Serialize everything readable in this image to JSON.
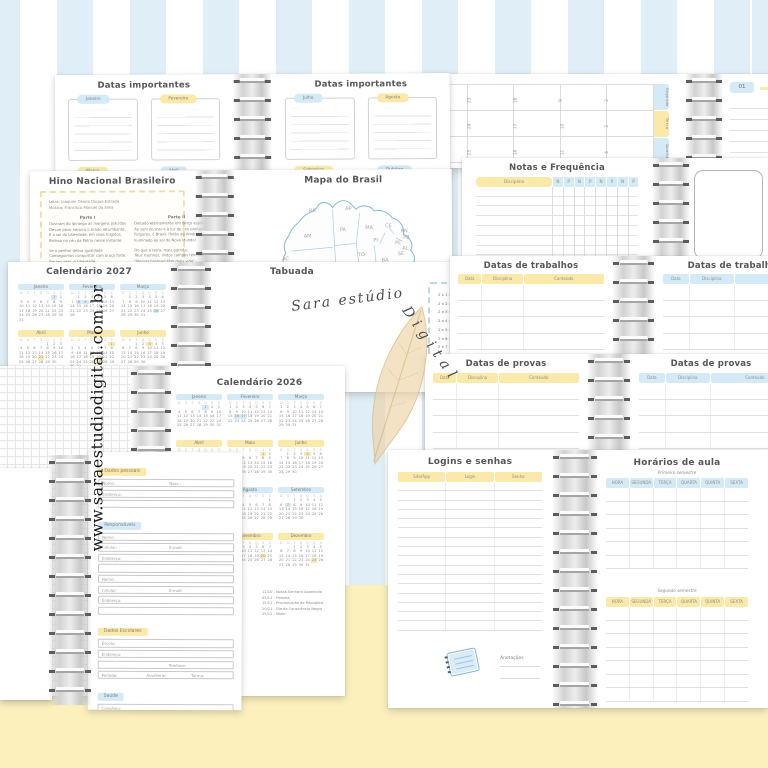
{
  "background": {
    "stripe_blue": "#e0eef7",
    "bottom_yellow": "#fcf1bd"
  },
  "palette": {
    "blue": "#d4eaf6",
    "yellow": "#fbe9a9"
  },
  "watermark": {
    "site": "www.saraestudiodigital.com.br",
    "brand_part1": "Sara estúdio",
    "brand_part2": "Digital"
  },
  "weekday_letters": [
    "D",
    "S",
    "T",
    "Q",
    "Q",
    "S",
    "S"
  ],
  "datas_importantes": {
    "title": "Datas importantes",
    "left_months": [
      {
        "name": "Janeiro",
        "hue": "blue"
      },
      {
        "name": "Fevereiro",
        "hue": "yellow"
      },
      {
        "name": "Março",
        "hue": "yellow"
      },
      {
        "name": "Abril",
        "hue": "blue"
      }
    ],
    "right_months": [
      {
        "name": "Julho",
        "hue": "blue"
      },
      {
        "name": "Agosto",
        "hue": "yellow"
      },
      {
        "name": "Setembro",
        "hue": "yellow"
      },
      {
        "name": "Outubro",
        "hue": "blue"
      }
    ]
  },
  "monthly_view": {
    "date_label": "01",
    "day_tabs": [
      {
        "name": "Segunda",
        "hue": "blue"
      },
      {
        "name": "Terça",
        "hue": "yellow"
      },
      {
        "name": "Quarta",
        "hue": "blue"
      }
    ],
    "grid_numbers": [
      [
        "30",
        "23",
        "16",
        "9",
        "2"
      ],
      [
        "31",
        "24",
        "17",
        "10",
        "3"
      ],
      [
        "1",
        "25",
        "18",
        "11",
        "4"
      ]
    ]
  },
  "notas": {
    "title": "Notas e Frequência",
    "disciplina": "Disciplina",
    "cols": [
      "N",
      "P",
      "N",
      "P",
      "N",
      "P",
      "N",
      "P"
    ],
    "rows": 8
  },
  "hino": {
    "title": "Hino Nacional Brasileiro",
    "credits": [
      "Letra: Joaquim Osório Duque Estrada",
      "Música: Francisco Manuel da Silva"
    ],
    "part1_title": "Parte I",
    "part2_title": "Parte II",
    "part1": [
      "Ouviram do Ipiranga as margens plácidas",
      "De um povo heroico o brado retumbante,",
      "E o sol da Liberdade, em raios fúlgidos,",
      "Brilhou no céu da Pátria nesse instante.",
      "",
      "Se o penhor dessa igualdade",
      "Conseguimos conquistar com braço forte,",
      "Em teu seio, ó Liberdade,",
      "Desafia o nosso peito a própria morte!"
    ],
    "part2": [
      "Deitado eternamente em berço esplêndido,",
      "Ao som do mar e à luz do céu profundo,",
      "Fulguras, ó Brasil, florão da América,",
      "Iluminado ao sol do Novo Mundo!",
      "",
      "Do que a terra, mais garrida,",
      "Teus risonhos, lindos campos têm mais flores;",
      "\"Nossos bosques têm mais vida\",",
      "\"Nossa vida\" no teu seio \"mais amores.\""
    ]
  },
  "mapa": {
    "title": "Mapa do Brasil",
    "states": [
      {
        "t": "RR",
        "x": 62,
        "y": 27
      },
      {
        "t": "AP",
        "x": 102,
        "y": 25
      },
      {
        "t": "AM",
        "x": 56,
        "y": 55
      },
      {
        "t": "PA",
        "x": 96,
        "y": 48
      },
      {
        "t": "MA",
        "x": 124,
        "y": 46
      },
      {
        "t": "CE",
        "x": 146,
        "y": 44
      },
      {
        "t": "RN",
        "x": 163,
        "y": 50
      },
      {
        "t": "PB",
        "x": 166,
        "y": 57
      },
      {
        "t": "PE",
        "x": 157,
        "y": 63
      },
      {
        "t": "AL",
        "x": 165,
        "y": 69
      },
      {
        "t": "SE",
        "x": 160,
        "y": 75
      },
      {
        "t": "PI",
        "x": 133,
        "y": 60
      },
      {
        "t": "BA",
        "x": 142,
        "y": 82
      },
      {
        "t": "TO",
        "x": 116,
        "y": 76
      },
      {
        "t": "RO",
        "x": 58,
        "y": 86
      },
      {
        "t": "AC",
        "x": 32,
        "y": 80
      },
      {
        "t": "MT",
        "x": 84,
        "y": 90
      },
      {
        "t": "DF",
        "x": 120,
        "y": 94
      },
      {
        "t": "GO",
        "x": 112,
        "y": 102
      },
      {
        "t": "MG",
        "x": 134,
        "y": 108
      },
      {
        "t": "MS",
        "x": 92,
        "y": 118
      },
      {
        "t": "ES",
        "x": 153,
        "y": 112
      },
      {
        "t": "RJ",
        "x": 143,
        "y": 121
      },
      {
        "t": "SP",
        "x": 116,
        "y": 126
      },
      {
        "t": "PR",
        "x": 106,
        "y": 138
      },
      {
        "t": "SC",
        "x": 101,
        "y": 148
      },
      {
        "t": "RS",
        "x": 93,
        "y": 160
      }
    ]
  },
  "calendario_2027": {
    "title": "Calendário 2027",
    "months": [
      {
        "name": "Janeiro",
        "days": 31,
        "start": 5,
        "hue": "blue",
        "marks": [
          1
        ]
      },
      {
        "name": "Fevereiro",
        "days": 28,
        "start": 1,
        "hue": "blue",
        "marks": [
          8,
          9
        ]
      },
      {
        "name": "Março",
        "days": 31,
        "start": 1,
        "hue": "blue",
        "marks": [
          26
        ]
      },
      {
        "name": "Abril",
        "days": 30,
        "start": 4,
        "hue": "yellow",
        "marks": [
          21
        ]
      },
      {
        "name": "Maio",
        "days": 31,
        "start": 6,
        "hue": "yellow",
        "marks": [
          1,
          27
        ]
      },
      {
        "name": "Junho",
        "days": 30,
        "start": 2,
        "hue": "yellow",
        "marks": [
          3
        ]
      }
    ]
  },
  "tabuada": {
    "title": "Tabuada",
    "tables": [
      2,
      3,
      4
    ],
    "rows_per_table": 10
  },
  "trabalhos": {
    "title": "Datas de trabalhos",
    "cols": [
      "Data",
      "Disciplina",
      "Conteúdo"
    ],
    "rows": 4
  },
  "provas": {
    "title": "Datas de provas",
    "cols": [
      "Data",
      "Disciplina",
      "Conteúdo"
    ],
    "rows": 4
  },
  "calendario_2026": {
    "title": "Calendário 2026",
    "months": [
      {
        "name": "Janeiro",
        "days": 31,
        "start": 4,
        "hue": "blue",
        "marks": [
          1
        ]
      },
      {
        "name": "Fevereiro",
        "days": 28,
        "start": 0,
        "hue": "blue",
        "marks": [
          16,
          17
        ]
      },
      {
        "name": "Março",
        "days": 31,
        "start": 0,
        "hue": "blue",
        "marks": []
      },
      {
        "name": "Abril",
        "days": 30,
        "start": 3,
        "hue": "yellow",
        "marks": [
          3,
          21
        ]
      },
      {
        "name": "Maio",
        "days": 31,
        "start": 5,
        "hue": "yellow",
        "marks": [
          1
        ]
      },
      {
        "name": "Junho",
        "days": 30,
        "start": 1,
        "hue": "yellow",
        "marks": [
          4
        ]
      },
      {
        "name": "Julho",
        "days": 31,
        "start": 3,
        "hue": "blue",
        "marks": []
      },
      {
        "name": "Agosto",
        "days": 31,
        "start": 6,
        "hue": "blue",
        "marks": []
      },
      {
        "name": "Setembro",
        "days": 30,
        "start": 2,
        "hue": "blue",
        "marks": [
          7
        ]
      },
      {
        "name": "Outubro",
        "days": 31,
        "start": 4,
        "hue": "yellow",
        "marks": [
          12
        ]
      },
      {
        "name": "Novembro",
        "days": 30,
        "start": 0,
        "hue": "yellow",
        "marks": [
          2,
          15,
          20
        ]
      },
      {
        "name": "Dezembro",
        "days": 31,
        "start": 2,
        "hue": "yellow",
        "marks": [
          25
        ]
      }
    ],
    "holidays_left": [
      "21/04 - Tiradentes",
      "01/05 - Dia do Trabalhador",
      "04/06 - Corpus Christi",
      "07/09 - Independência do Brasil"
    ],
    "holidays_right": [
      "12/10 - Nossa Senhora Aparecida",
      "02/11 - Finados",
      "15/11 - Proclamação da República",
      "20/11 - Dia da Consciência Negra",
      "25/12 - Natal"
    ]
  },
  "dados_pessoais": {
    "sections": [
      {
        "label": "Dados pessoais",
        "hue": "yellow",
        "rows": [
          [
            "Nome:",
            "Nasc.:"
          ],
          [
            "Endereço:"
          ],
          [
            ""
          ]
        ]
      },
      {
        "label": "Responsáveis",
        "hue": "blue",
        "rows": [
          [
            "Nome:"
          ],
          [
            "Celular:",
            "E-mail:"
          ],
          [
            "Endereço:"
          ],
          [
            ""
          ],
          [
            "Nome:"
          ],
          [
            "Celular:",
            "E-mail:"
          ],
          [
            "Endereço:"
          ],
          [
            ""
          ]
        ]
      },
      {
        "label": "Dados Escolares",
        "hue": "yellow",
        "rows": [
          [
            "Escola:"
          ],
          [
            "Endereço:"
          ],
          [
            "",
            "Telefone:"
          ],
          [
            "Período:",
            "Ano/Série:",
            "Turma:"
          ]
        ]
      },
      {
        "label": "Saúde",
        "hue": "blue",
        "rows": [
          [
            "Convênio:"
          ],
          [
            "Tipo sanguíneo:",
            "Fator RH:"
          ],
          [
            "Alergias:"
          ],
          [
            ""
          ]
        ]
      }
    ]
  },
  "logins": {
    "title": "Logins e senhas",
    "cols": [
      "Site/App",
      "Login",
      "Senha"
    ],
    "rows": 16,
    "anotacoes_label": "Anotações"
  },
  "horarios": {
    "title": "Horários de aula",
    "sem1_label": "Primeiro semestre",
    "sem2_label": "Segundo semestre",
    "cols": [
      "HORA",
      "SEGUNDA",
      "TERÇA",
      "QUARTA",
      "QUINTA",
      "SEXTA"
    ],
    "rows_sem1": 6,
    "rows_sem2": 7
  }
}
